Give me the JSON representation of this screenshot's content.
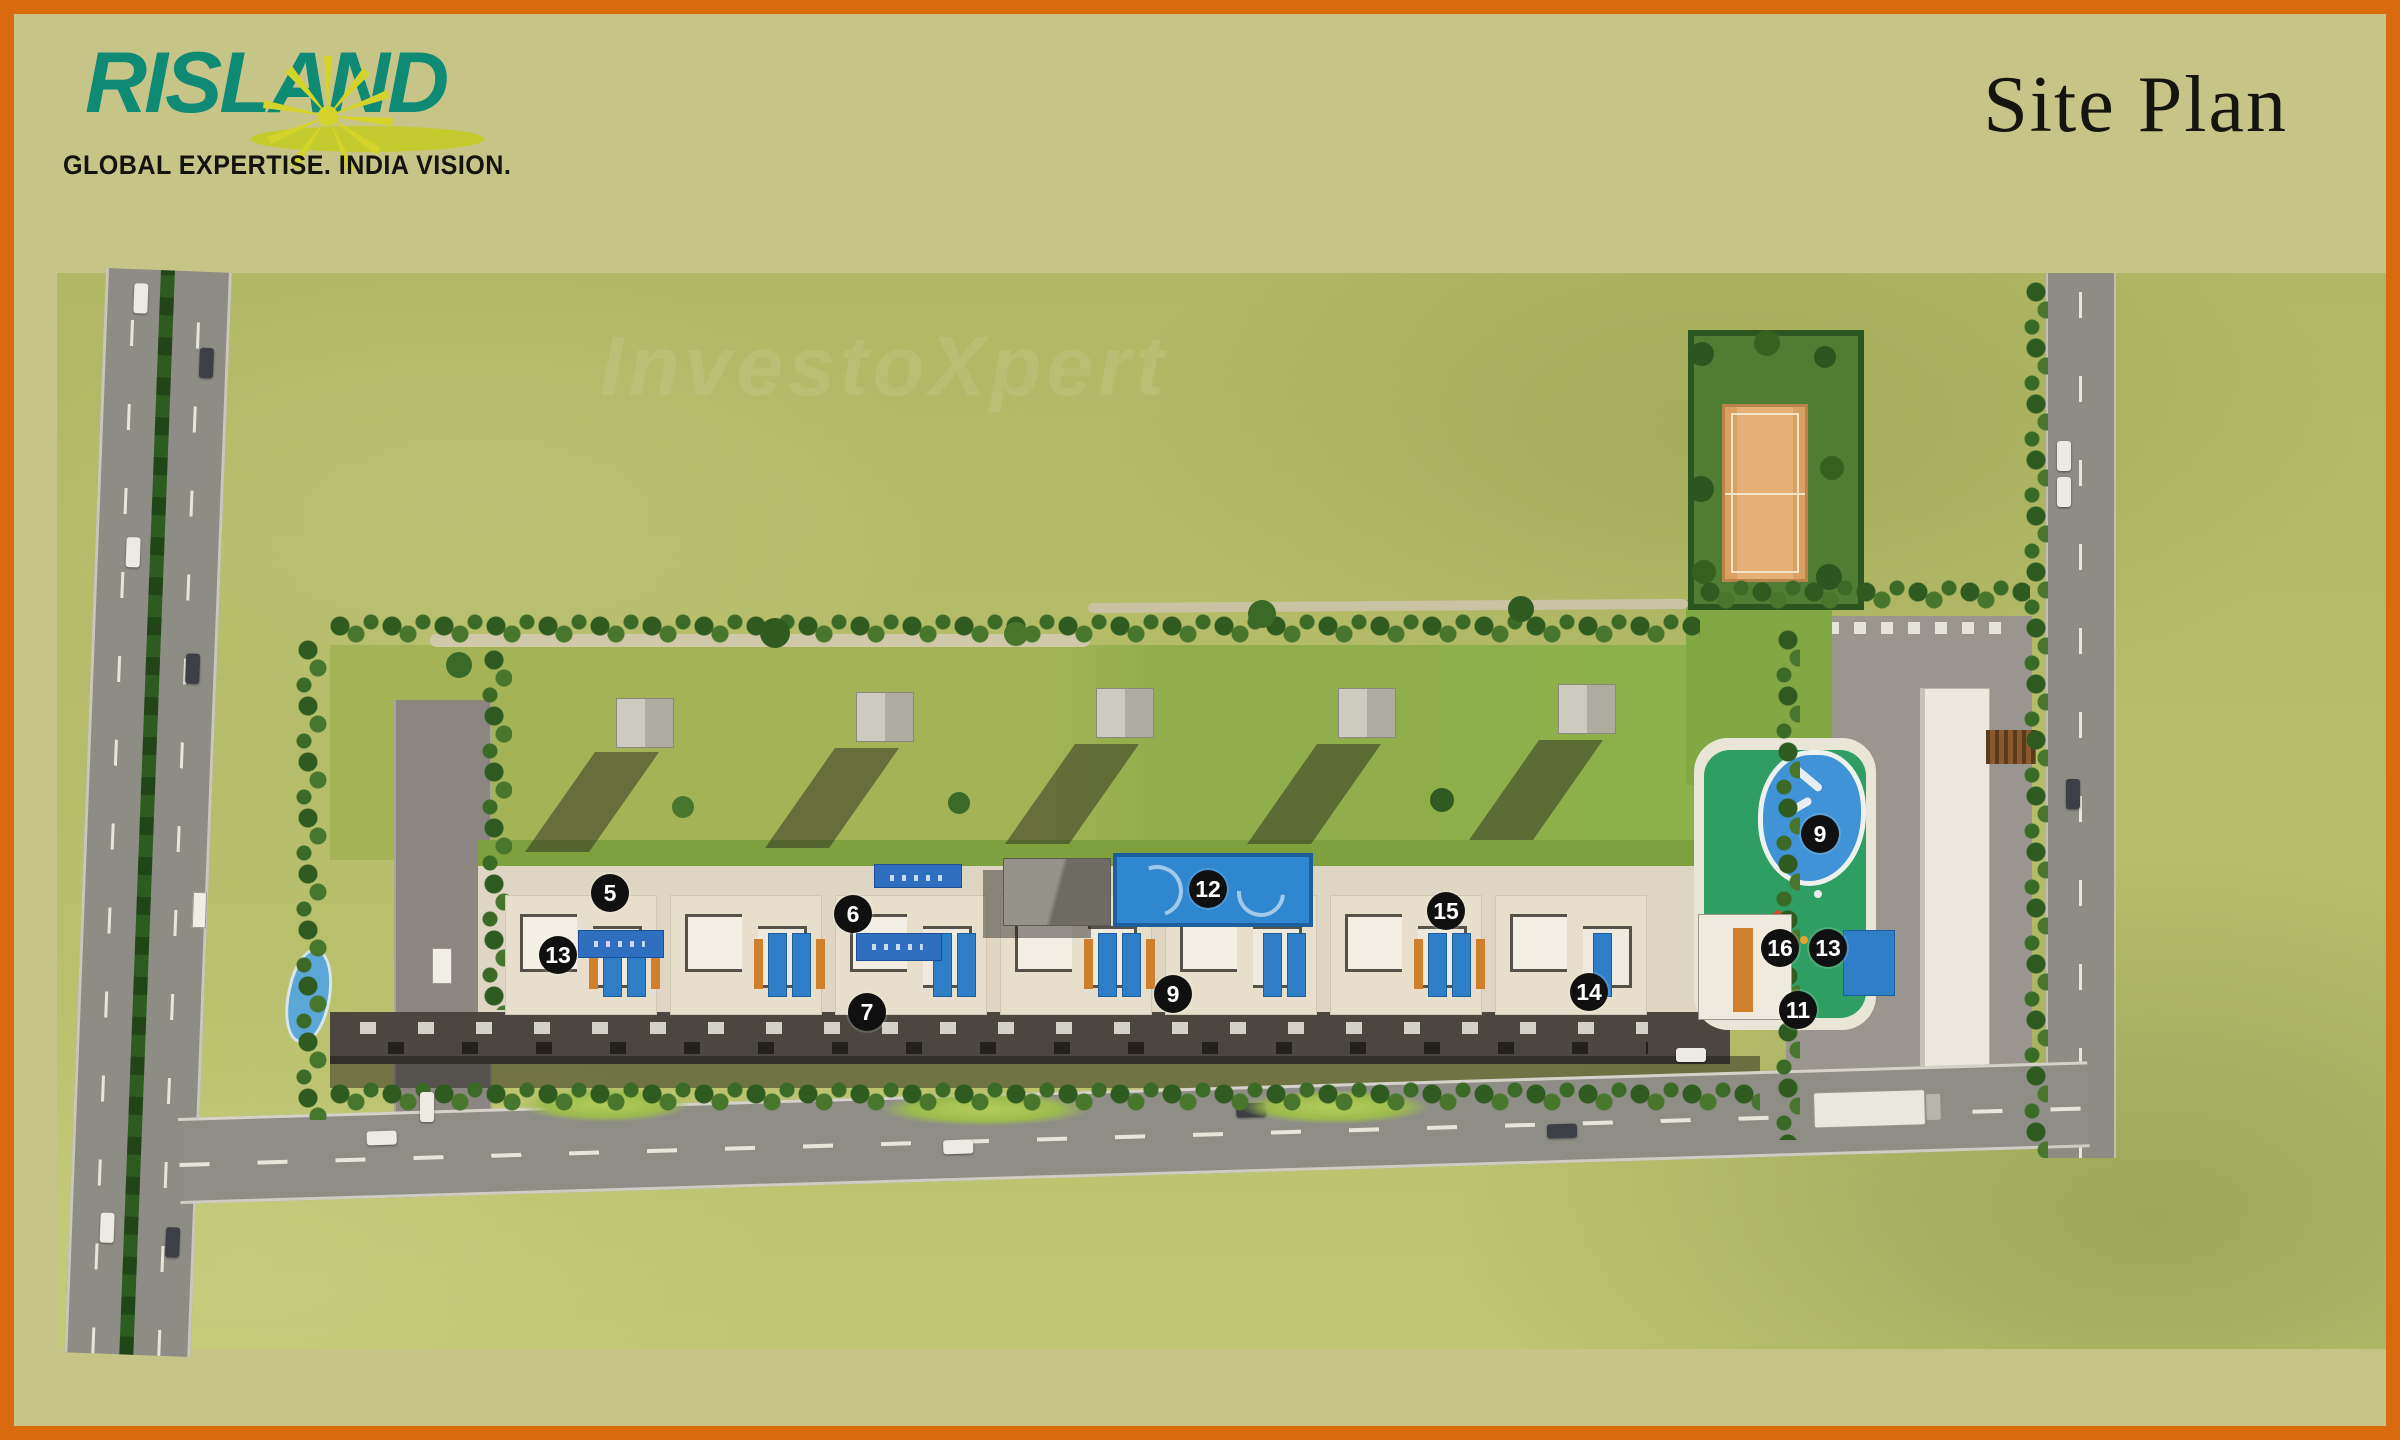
{
  "header": {
    "logo_text": "RISLAND",
    "logo_tagline": "GLOBAL EXPERTISE. INDIA VISION.",
    "page_title": "Site Plan"
  },
  "watermark": "InvestoXpert",
  "site_plan": {
    "markers": [
      {
        "n": "5",
        "x": 610,
        "y": 893
      },
      {
        "n": "13",
        "x": 558,
        "y": 955
      },
      {
        "n": "6",
        "x": 853,
        "y": 914
      },
      {
        "n": "7",
        "x": 867,
        "y": 1012
      },
      {
        "n": "12",
        "x": 1208,
        "y": 889
      },
      {
        "n": "9",
        "x": 1173,
        "y": 994
      },
      {
        "n": "15",
        "x": 1446,
        "y": 911
      },
      {
        "n": "14",
        "x": 1589,
        "y": 992
      },
      {
        "n": "9",
        "x": 1820,
        "y": 834
      },
      {
        "n": "16",
        "x": 1780,
        "y": 948
      },
      {
        "n": "13",
        "x": 1828,
        "y": 948
      },
      {
        "n": "11",
        "x": 1798,
        "y": 1010
      }
    ]
  },
  "colors": {
    "border_orange": "#d96a0e",
    "mat_khaki": "#c7c488",
    "logo_teal": "#0f8a74",
    "logo_yellow": "#cfd02b",
    "pool_blue": "#2f87cf",
    "marker_black": "#101010"
  }
}
